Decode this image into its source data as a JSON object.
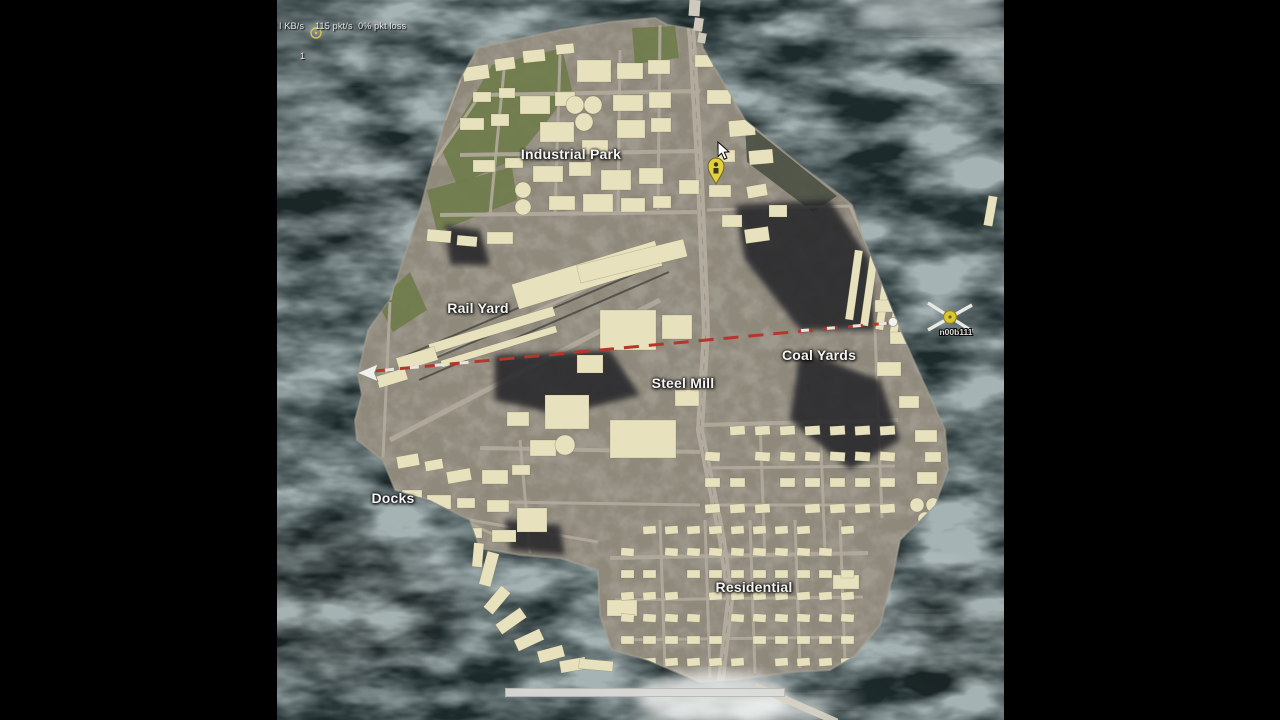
{
  "scene": {
    "type": "game-tactical-map",
    "letterbox": true
  },
  "hud": {
    "net_line1": "I KB/s    115 pkt/s  0% pkt loss",
    "net_line2": "1"
  },
  "map": {
    "labels": [
      {
        "id": "industrial-park",
        "text": "Industrial Park"
      },
      {
        "id": "rail-yard",
        "text": "Rail Yard"
      },
      {
        "id": "coal-yards",
        "text": "Coal Yards"
      },
      {
        "id": "steel-mill",
        "text": "Steel Mill"
      },
      {
        "id": "docks",
        "text": "Docks"
      },
      {
        "id": "residential",
        "text": "Residential"
      }
    ],
    "player_marker": {
      "name": "n00b111",
      "type": "helicopter-icon"
    },
    "markers": [
      {
        "id": "ping-ring",
        "type": "yellow-ring"
      },
      {
        "id": "objective-pin",
        "type": "yellow-balloon-pin"
      }
    ],
    "route": {
      "type": "dashed-line",
      "color": "#b5362a",
      "arrow_end": "west",
      "dot_end": "east"
    }
  },
  "colors": {
    "water": "#1d2a2c",
    "island": "#8f897c",
    "building": "#e8e1bd",
    "coal": "#26262b",
    "road": "#b2ab9d",
    "green": "#6d7b49",
    "route_red": "#b5362a",
    "marker_yellow": "#e2cd3c",
    "label": "#f4f4f2"
  },
  "scrollbar": {
    "visible": true
  }
}
